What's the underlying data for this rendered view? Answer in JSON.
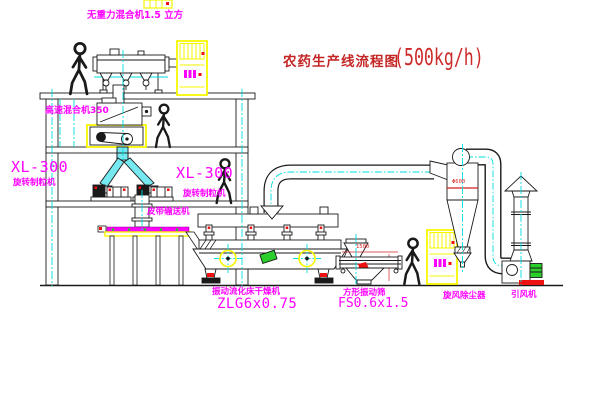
{
  "title": {
    "text": "农药生产线流程图",
    "capacity": "(500kg/h)"
  },
  "labels": {
    "gravity_mixer": "无重力混合机1.5 立方",
    "high_speed_mixer": "高速混合机350",
    "granulator_model_left": "XL-300",
    "granulator_name_left": "旋转制粒机",
    "granulator_model_right": "XL-300",
    "granulator_name_right": "旋转制粒机",
    "belt_conveyor": "皮带输送机",
    "dryer_name": "振动流化床干燥机",
    "dryer_model": "ZLG6x0.75",
    "sieve_name": "方形振动筛",
    "sieve_model": "FS0.6x1.5",
    "cyclone": "旋风除尘器",
    "draft_fan": "引风机"
  },
  "dimensions": {
    "cyclone_diameter": "Φ600",
    "sieve_length": "1500"
  },
  "colors": {
    "label_magenta": "#ff00ff",
    "title_red": "#c42525",
    "centerline_cyan": "#00dede",
    "highlight_yellow": "#f7f700",
    "accent_red": "#ee1111",
    "motor_green": "#2bcf2b",
    "line_black": "#1a1a1a"
  }
}
